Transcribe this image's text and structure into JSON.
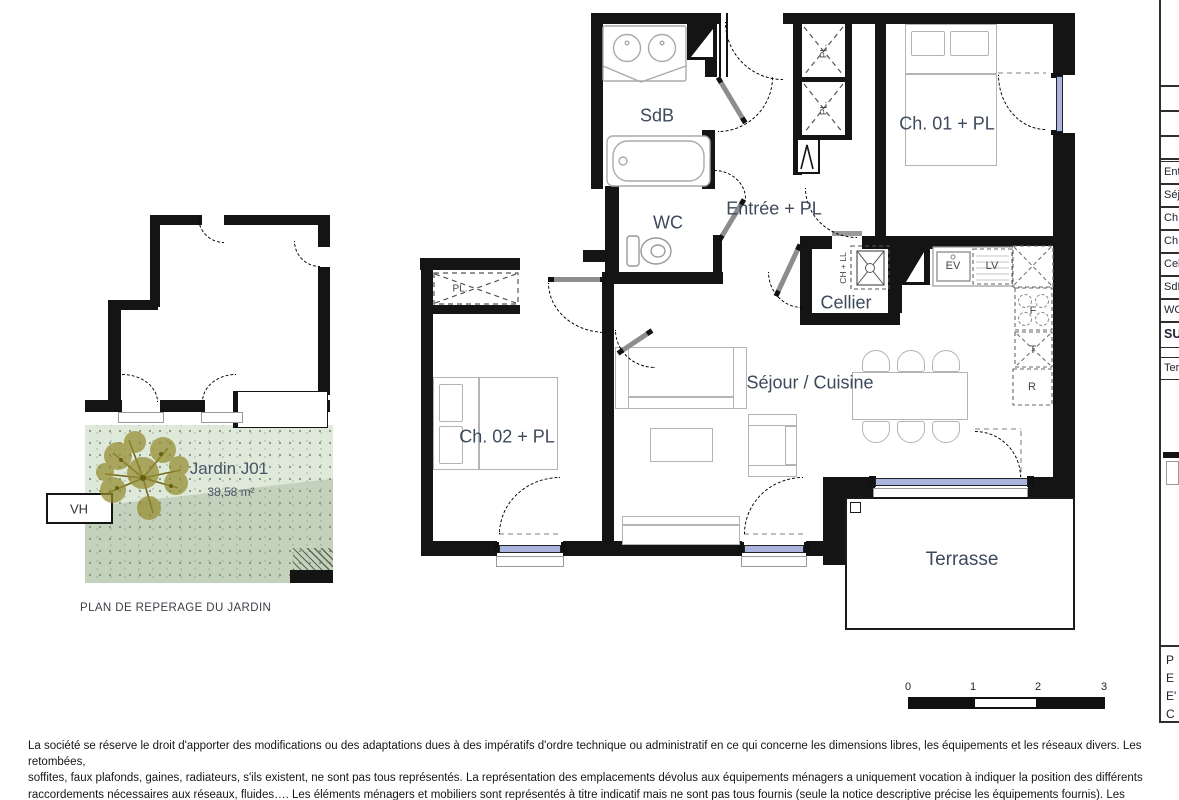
{
  "rooms": {
    "sdb": "SdB",
    "wc": "WC",
    "entree": "Entrée + PL",
    "ch01": "Ch. 01 + PL",
    "cellier": "Cellier",
    "sejour": "Séjour / Cuisine",
    "ch02": "Ch. 02 + PL",
    "terrasse": "Terrasse"
  },
  "fixtures": {
    "ev": "EV",
    "lv": "LV",
    "four": "F",
    "t": "T",
    "r": "R",
    "pl": "PL.",
    "ch_ll": "CH + LL",
    "vh": "VH"
  },
  "garden": {
    "name": "Jardin J01",
    "area": "38,58 m²",
    "caption": "PLAN DE REPERAGE DU JARDIN"
  },
  "side_table": {
    "rows": [
      "Ent",
      "Séj",
      "Ch.",
      "Ch.",
      "Cel",
      "SdB",
      "WC",
      "SU"
    ],
    "terrace": "Ter",
    "corner": [
      "P",
      "E",
      "E'",
      "C"
    ]
  },
  "scale": {
    "ticks": [
      "0",
      "1",
      "2",
      "3"
    ]
  },
  "disclaimer": " La société se réserve le droit d'apporter des modifications ou des adaptations dues à des impératifs d'ordre technique ou administratif en ce qui concerne les dimensions libres, les équipements et les réseaux divers. Les retombées,\nsoffites, faux plafonds, gaines, radiateurs, s'ils existent, ne sont pas tous représentés. La représentation des emplacements dévolus aux équipements ménagers a uniquement vocation à indiquer la position des différents\nraccordements nécessaires aux réseaux, fluides…. Les éléments ménagers et mobiliers sont représentés à titre indicatif mais ne sont pas tous fournis (seule la notice descriptive précise les équipements fournis). Les surfaces y\ncompris celles des jardins sont approximatives et susceptibles dêtre modifiées."
}
